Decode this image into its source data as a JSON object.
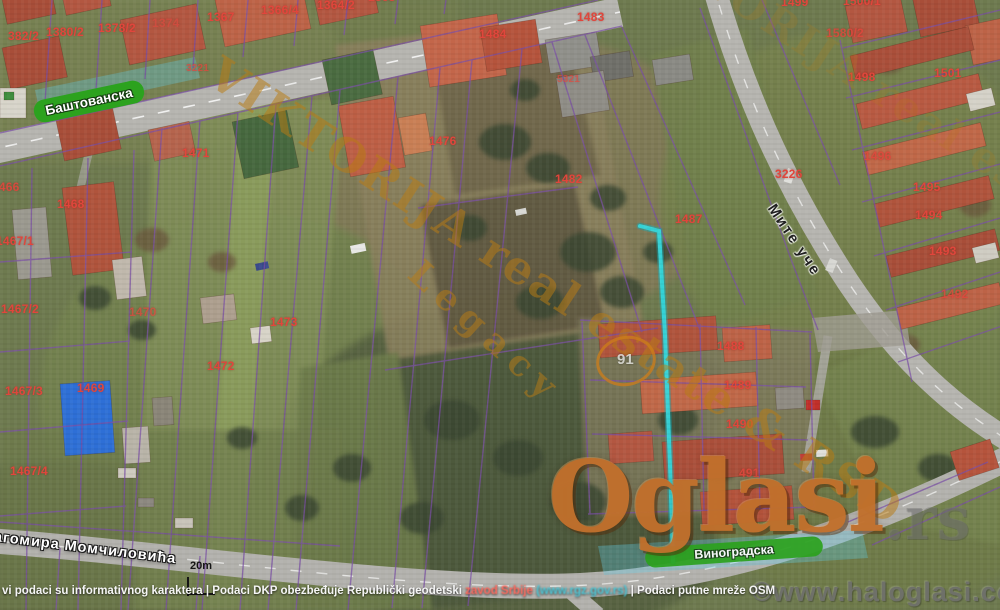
{
  "map": {
    "parcel_labels": [
      {
        "t": "382/2",
        "x": 8,
        "y": 30
      },
      {
        "t": "1380/2",
        "x": 46,
        "y": 26
      },
      {
        "t": "1378/2",
        "x": 98,
        "y": 22
      },
      {
        "t": "1374",
        "x": 152,
        "y": 17,
        "o": 0.6
      },
      {
        "t": "1367",
        "x": 207,
        "y": 11
      },
      {
        "t": "1366/4",
        "x": 261,
        "y": 4
      },
      {
        "t": "1364/2",
        "x": 317,
        "y": -1
      },
      {
        "t": "1363",
        "x": 368,
        "y": -9,
        "o": 0.9
      },
      {
        "t": "3221",
        "x": 186,
        "y": 64,
        "s": 10,
        "o": 0.75
      },
      {
        "t": "1484",
        "x": 479,
        "y": 28
      },
      {
        "t": "1483",
        "x": 577,
        "y": 11
      },
      {
        "t": "5321",
        "x": 557,
        "y": 75,
        "s": 10,
        "o": 0.7
      },
      {
        "t": "1499",
        "x": 781,
        "y": -4
      },
      {
        "t": "1500/1",
        "x": 843,
        "y": -5
      },
      {
        "t": "1580/2",
        "x": 826,
        "y": 27,
        "o": 0.85
      },
      {
        "t": "1498",
        "x": 848,
        "y": 71
      },
      {
        "t": "1501",
        "x": 934,
        "y": 67
      },
      {
        "t": "3226",
        "x": 775,
        "y": 168
      },
      {
        "t": "1496",
        "x": 864,
        "y": 150,
        "o": 0.85
      },
      {
        "t": "1495",
        "x": 913,
        "y": 181
      },
      {
        "t": "1494",
        "x": 915,
        "y": 209
      },
      {
        "t": "1493",
        "x": 929,
        "y": 245
      },
      {
        "t": "1492",
        "x": 941,
        "y": 288,
        "o": 0.8
      },
      {
        "t": "1476",
        "x": 429,
        "y": 135
      },
      {
        "t": "1482",
        "x": 555,
        "y": 173
      },
      {
        "t": "1487",
        "x": 675,
        "y": 213
      },
      {
        "t": "1471",
        "x": 182,
        "y": 147
      },
      {
        "t": "1466",
        "x": -8,
        "y": 181,
        "o": 0.9
      },
      {
        "t": "1468",
        "x": 57,
        "y": 198
      },
      {
        "t": "1467/1",
        "x": -4,
        "y": 235
      },
      {
        "t": "1467/2",
        "x": 1,
        "y": 303
      },
      {
        "t": "1470",
        "x": 129,
        "y": 306,
        "o": 0.75
      },
      {
        "t": "1473",
        "x": 270,
        "y": 316
      },
      {
        "t": "1472",
        "x": 207,
        "y": 360
      },
      {
        "t": "1467/3",
        "x": 5,
        "y": 385
      },
      {
        "t": "1469",
        "x": 77,
        "y": 382
      },
      {
        "t": "1467/4",
        "x": 10,
        "y": 465
      },
      {
        "t": "1488",
        "x": 717,
        "y": 340
      },
      {
        "t": "1489",
        "x": 724,
        "y": 379
      },
      {
        "t": "1490",
        "x": 726,
        "y": 418
      },
      {
        "t": "491",
        "x": 739,
        "y": 467,
        "o": 0.85
      }
    ],
    "streets": {
      "bastovanska": "Баштованска",
      "mite_uce": "Мите уче",
      "momcilovica": "агомира Момчиловића",
      "vinogradska": "Виноградска"
    },
    "scale": {
      "label": "20m"
    },
    "watermarks": {
      "agency": "VIKTORIJA real estate & RSD",
      "agency2": "Legacy",
      "circle": "91",
      "brand": "Oglasi",
      "brand_tld": ".rs",
      "copyright": "©www.haloglasi.com"
    },
    "attribution": {
      "part1": "vi podaci su informativnog karaktera | Podaci DKP obezbeđuje Republički geodetski ",
      "authority": "zavod Srbije",
      "link": "(www.rgz.gov.rs)",
      "part2": " | Podaci putne mreže OSM"
    },
    "colors": {
      "parcel_label": "#e0463c",
      "cadastral_line": "#7a4fa5",
      "highlight_cyan": "#35d6da",
      "street_badge_green": "#2ca21e",
      "watermark_gold": "#b97c14",
      "brand_orange": "#c1702c"
    }
  }
}
